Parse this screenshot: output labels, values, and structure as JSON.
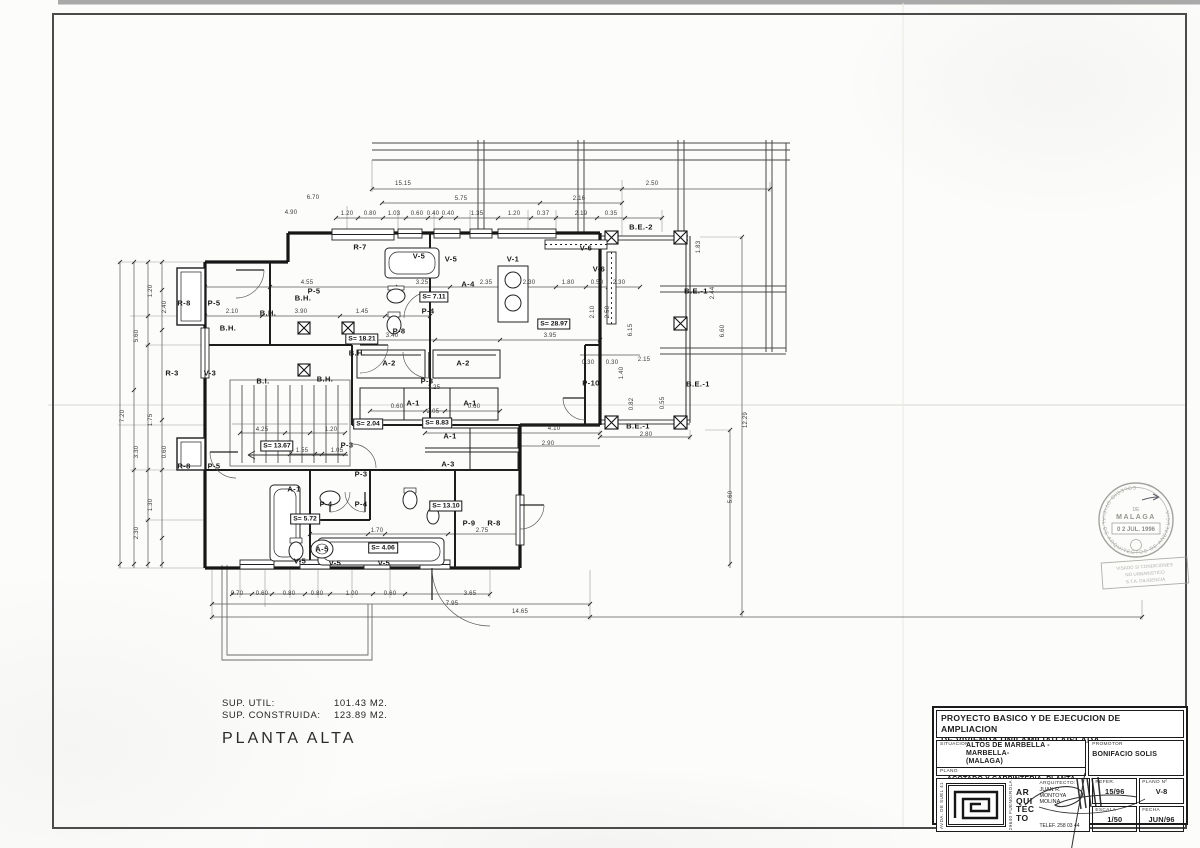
{
  "colors": {
    "ink": "#1a1a1a",
    "dim": "#3a3a3a",
    "frame": "#4b4b4b",
    "stamp": "#8a8a86"
  },
  "summary": {
    "sup_util_label": "SUP. UTIL:",
    "sup_util_value": "101.43 M2.",
    "sup_construida_label": "SUP. CONSTRUIDA:",
    "sup_construida_value": "123.89 M2.",
    "floor_title": "PLANTA ALTA"
  },
  "title_block": {
    "title_line1": "PROYECTO BASICO Y DE EJECUCION DE AMPLIACION",
    "title_line2": "DE VIVIENDA UNIFAMILIAR AISLADA",
    "situacion_label": "SITUACION",
    "situacion_value1": "ALTOS DE MARBELLA -MARBELLA-",
    "situacion_value2": "(MALAGA)",
    "plano_label": "PLANO",
    "plano_value": "ACOTADO Y CARPINTERIA, PLANTA ALTA",
    "promotor_label": "PROMOTOR",
    "promotor_value": "BONIFACIO SOLIS",
    "address_left": "AVDA. DE SUEL 41",
    "address_right": "29640 FUENGIROLA",
    "logo_word1": "AR",
    "logo_word2": "QUI",
    "logo_word3": "TEC",
    "logo_word4": "TO",
    "arquitecto_label": "ARQUITECTO:",
    "arquitecto_value": "JUAN R. MONTOYA MOLINA",
    "telefono": "TELEF. 258 03 44",
    "refer_label": "REFER.",
    "refer_value": "15/96",
    "plano_num_label": "PLANO Nº",
    "plano_num_value": "V-8",
    "escala_label": "ESCALA",
    "escala_value": "1/50",
    "fecha_label": "FECHA",
    "fecha_value": "JUN/96"
  },
  "stamp": {
    "arc_text": "COLEGIO OFICIAL DE ARQUITECTOS DE ANDALUCIA",
    "de": "DE",
    "place": "MALAGA",
    "date": "0 2 JUL. 1996",
    "visa_lines": [
      "VISADO S/ CONDICIONES",
      "NO URBANISTICO",
      "S.T.A.  DILIGENCIA"
    ]
  },
  "plan": {
    "annotations": [
      {
        "t": "R-7",
        "x": 360,
        "y": 247,
        "k": "c"
      },
      {
        "t": "P-5",
        "x": 314,
        "y": 291,
        "k": "c"
      },
      {
        "t": "V-5",
        "x": 419,
        "y": 256,
        "k": "c"
      },
      {
        "t": "V-5",
        "x": 451,
        "y": 259,
        "k": "c"
      },
      {
        "t": "V-1",
        "x": 513,
        "y": 259,
        "k": "c"
      },
      {
        "t": "A-4",
        "x": 468,
        "y": 284,
        "k": "c"
      },
      {
        "t": "P-4",
        "x": 428,
        "y": 311,
        "k": "c"
      },
      {
        "t": "P-8",
        "x": 399,
        "y": 331,
        "k": "c"
      },
      {
        "t": "B.H.",
        "x": 303,
        "y": 298,
        "k": "c"
      },
      {
        "t": "B.H.",
        "x": 268,
        "y": 313,
        "k": "c"
      },
      {
        "t": "B.H.",
        "x": 228,
        "y": 328,
        "k": "c"
      },
      {
        "t": "B.H.",
        "x": 357,
        "y": 353,
        "k": "c"
      },
      {
        "t": "B.H.",
        "x": 325,
        "y": 379,
        "k": "c"
      },
      {
        "t": "B.I.",
        "x": 263,
        "y": 381,
        "k": "c"
      },
      {
        "t": "R-8",
        "x": 184,
        "y": 303,
        "k": "c"
      },
      {
        "t": "P-5",
        "x": 214,
        "y": 303,
        "k": "c"
      },
      {
        "t": "R-3",
        "x": 172,
        "y": 373,
        "k": "c"
      },
      {
        "t": "V-3",
        "x": 210,
        "y": 373,
        "k": "c"
      },
      {
        "t": "V-6",
        "x": 586,
        "y": 248,
        "k": "c"
      },
      {
        "t": "V-6",
        "x": 599,
        "y": 269,
        "k": "c"
      },
      {
        "t": "B.E.-2",
        "x": 641,
        "y": 227,
        "k": "c"
      },
      {
        "t": "B.E.-1",
        "x": 696,
        "y": 291,
        "k": "c"
      },
      {
        "t": "B.E.-1",
        "x": 698,
        "y": 384,
        "k": "c"
      },
      {
        "t": "B.E.-1",
        "x": 638,
        "y": 426,
        "k": "c"
      },
      {
        "t": "P-10",
        "x": 591,
        "y": 383,
        "k": "c"
      },
      {
        "t": "A-2",
        "x": 389,
        "y": 363,
        "k": "c"
      },
      {
        "t": "A-2",
        "x": 463,
        "y": 363,
        "k": "c"
      },
      {
        "t": "P-3",
        "x": 427,
        "y": 381,
        "k": "c"
      },
      {
        "t": "A-1",
        "x": 413,
        "y": 403,
        "k": "c"
      },
      {
        "t": "A-1",
        "x": 470,
        "y": 403,
        "k": "c"
      },
      {
        "t": "A-1",
        "x": 450,
        "y": 436,
        "k": "c"
      },
      {
        "t": "A-3",
        "x": 448,
        "y": 464,
        "k": "c"
      },
      {
        "t": "P-3",
        "x": 347,
        "y": 445,
        "k": "c"
      },
      {
        "t": "P-3",
        "x": 361,
        "y": 474,
        "k": "c"
      },
      {
        "t": "A-1",
        "x": 294,
        "y": 489,
        "k": "c"
      },
      {
        "t": "P-4",
        "x": 326,
        "y": 504,
        "k": "c"
      },
      {
        "t": "P-4",
        "x": 361,
        "y": 504,
        "k": "c"
      },
      {
        "t": "P-5",
        "x": 214,
        "y": 466,
        "k": "c"
      },
      {
        "t": "R-8",
        "x": 184,
        "y": 466,
        "k": "c"
      },
      {
        "t": "A-5",
        "x": 322,
        "y": 549,
        "k": "c"
      },
      {
        "t": "V-5",
        "x": 300,
        "y": 561,
        "k": "c"
      },
      {
        "t": "V-5",
        "x": 335,
        "y": 563,
        "k": "c"
      },
      {
        "t": "V-5",
        "x": 384,
        "y": 563,
        "k": "c"
      },
      {
        "t": "P-9",
        "x": 469,
        "y": 523,
        "k": "c"
      },
      {
        "t": "R-8",
        "x": 494,
        "y": 523,
        "k": "c"
      },
      {
        "t": "S= 7.11",
        "x": 434,
        "y": 297,
        "k": "a"
      },
      {
        "t": "S= 18.21",
        "x": 362,
        "y": 339,
        "k": "a"
      },
      {
        "t": "S= 28.97",
        "x": 554,
        "y": 324,
        "k": "a"
      },
      {
        "t": "S= 2.04",
        "x": 368,
        "y": 424,
        "k": "a"
      },
      {
        "t": "S= 8.83",
        "x": 437,
        "y": 423,
        "k": "a"
      },
      {
        "t": "S= 13.67",
        "x": 277,
        "y": 446,
        "k": "a"
      },
      {
        "t": "S= 5.72",
        "x": 305,
        "y": 519,
        "k": "a"
      },
      {
        "t": "S= 4.06",
        "x": 383,
        "y": 548,
        "k": "a"
      },
      {
        "t": "S= 13.10",
        "x": 446,
        "y": 506,
        "k": "a"
      },
      {
        "t": "15.15",
        "x": 403,
        "y": 184,
        "k": "d"
      },
      {
        "t": "2.50",
        "x": 652,
        "y": 184,
        "k": "d"
      },
      {
        "t": "5.75",
        "x": 461,
        "y": 199,
        "k": "d"
      },
      {
        "t": "2.16",
        "x": 579,
        "y": 199,
        "k": "d"
      },
      {
        "t": "6.70",
        "x": 313,
        "y": 198,
        "k": "d"
      },
      {
        "t": "4.90",
        "x": 291,
        "y": 213,
        "k": "d"
      },
      {
        "t": "1.20",
        "x": 347,
        "y": 214,
        "k": "d"
      },
      {
        "t": "0.80",
        "x": 370,
        "y": 214,
        "k": "d"
      },
      {
        "t": "1.03",
        "x": 394,
        "y": 214,
        "k": "d"
      },
      {
        "t": "0.60",
        "x": 417,
        "y": 214,
        "k": "d"
      },
      {
        "t": "0.40",
        "x": 433,
        "y": 214,
        "k": "d"
      },
      {
        "t": "0.40",
        "x": 448,
        "y": 214,
        "k": "d"
      },
      {
        "t": "1.35",
        "x": 477,
        "y": 214,
        "k": "d"
      },
      {
        "t": "1.20",
        "x": 514,
        "y": 214,
        "k": "d"
      },
      {
        "t": "0.37",
        "x": 543,
        "y": 214,
        "k": "d"
      },
      {
        "t": "2.19",
        "x": 581,
        "y": 214,
        "k": "d"
      },
      {
        "t": "0.35",
        "x": 611,
        "y": 214,
        "k": "d"
      },
      {
        "t": "1.83",
        "x": 699,
        "y": 247,
        "k": "v"
      },
      {
        "t": "4.55",
        "x": 307,
        "y": 283,
        "k": "d"
      },
      {
        "t": "3.25",
        "x": 422,
        "y": 283,
        "k": "d"
      },
      {
        "t": "2.35",
        "x": 486,
        "y": 283,
        "k": "d"
      },
      {
        "t": "2.30",
        "x": 529,
        "y": 283,
        "k": "d"
      },
      {
        "t": "1.80",
        "x": 568,
        "y": 283,
        "k": "d"
      },
      {
        "t": "0.50",
        "x": 597,
        "y": 283,
        "k": "d"
      },
      {
        "t": "2.30",
        "x": 619,
        "y": 283,
        "k": "d"
      },
      {
        "t": "2.10",
        "x": 232,
        "y": 312,
        "k": "d"
      },
      {
        "t": "3.90",
        "x": 301,
        "y": 312,
        "k": "d"
      },
      {
        "t": "1.45",
        "x": 362,
        "y": 312,
        "k": "d"
      },
      {
        "t": "3.40",
        "x": 392,
        "y": 336,
        "k": "d"
      },
      {
        "t": "3.95",
        "x": 550,
        "y": 336,
        "k": "d"
      },
      {
        "t": "3.25",
        "x": 434,
        "y": 388,
        "k": "d"
      },
      {
        "t": "0.60",
        "x": 397,
        "y": 407,
        "k": "d"
      },
      {
        "t": "0.60",
        "x": 474,
        "y": 407,
        "k": "d"
      },
      {
        "t": "2.05",
        "x": 433,
        "y": 412,
        "k": "d"
      },
      {
        "t": "4.10",
        "x": 554,
        "y": 429,
        "k": "d"
      },
      {
        "t": "2.90",
        "x": 548,
        "y": 444,
        "k": "d"
      },
      {
        "t": "4.25",
        "x": 262,
        "y": 430,
        "k": "d"
      },
      {
        "t": "1.20",
        "x": 331,
        "y": 430,
        "k": "d"
      },
      {
        "t": "1.55",
        "x": 302,
        "y": 451,
        "k": "d"
      },
      {
        "t": "1.05",
        "x": 337,
        "y": 451,
        "k": "d"
      },
      {
        "t": "1.70",
        "x": 377,
        "y": 531,
        "k": "d"
      },
      {
        "t": "2.75",
        "x": 482,
        "y": 531,
        "k": "d"
      },
      {
        "t": "2.80",
        "x": 646,
        "y": 435,
        "k": "d"
      },
      {
        "t": "2.15",
        "x": 644,
        "y": 360,
        "k": "d"
      },
      {
        "t": "0.30",
        "x": 588,
        "y": 363,
        "k": "d"
      },
      {
        "t": "0.30",
        "x": 612,
        "y": 363,
        "k": "d"
      },
      {
        "t": "0.70",
        "x": 237,
        "y": 594,
        "k": "d"
      },
      {
        "t": "0.60",
        "x": 262,
        "y": 594,
        "k": "d"
      },
      {
        "t": "0.80",
        "x": 289,
        "y": 594,
        "k": "d"
      },
      {
        "t": "0.80",
        "x": 317,
        "y": 594,
        "k": "d"
      },
      {
        "t": "1.00",
        "x": 352,
        "y": 594,
        "k": "d"
      },
      {
        "t": "0.60",
        "x": 390,
        "y": 594,
        "k": "d"
      },
      {
        "t": "3.65",
        "x": 470,
        "y": 594,
        "k": "d"
      },
      {
        "t": "7.95",
        "x": 452,
        "y": 604,
        "k": "d"
      },
      {
        "t": "14.65",
        "x": 520,
        "y": 612,
        "k": "d"
      },
      {
        "t": "1.20",
        "x": 151,
        "y": 291,
        "k": "v"
      },
      {
        "t": "2.40",
        "x": 165,
        "y": 307,
        "k": "v"
      },
      {
        "t": "5.60",
        "x": 137,
        "y": 336,
        "k": "v"
      },
      {
        "t": "1.75",
        "x": 151,
        "y": 420,
        "k": "v"
      },
      {
        "t": "7.20",
        "x": 123,
        "y": 416,
        "k": "v"
      },
      {
        "t": "3.30",
        "x": 137,
        "y": 452,
        "k": "v"
      },
      {
        "t": "0.60",
        "x": 165,
        "y": 452,
        "k": "v"
      },
      {
        "t": "1.30",
        "x": 151,
        "y": 505,
        "k": "v"
      },
      {
        "t": "2.30",
        "x": 137,
        "y": 533,
        "k": "v"
      },
      {
        "t": "2.10",
        "x": 593,
        "y": 312,
        "k": "v"
      },
      {
        "t": "2.50",
        "x": 608,
        "y": 312,
        "k": "v"
      },
      {
        "t": "6.15",
        "x": 631,
        "y": 330,
        "k": "v"
      },
      {
        "t": "6.60",
        "x": 723,
        "y": 331,
        "k": "v"
      },
      {
        "t": "2.44",
        "x": 713,
        "y": 293,
        "k": "v"
      },
      {
        "t": "1.40",
        "x": 622,
        "y": 373,
        "k": "v"
      },
      {
        "t": "0.82",
        "x": 632,
        "y": 404,
        "k": "v"
      },
      {
        "t": "0.55",
        "x": 663,
        "y": 403,
        "k": "v"
      },
      {
        "t": "12.29",
        "x": 746,
        "y": 420,
        "k": "v"
      },
      {
        "t": "5.60",
        "x": 731,
        "y": 497,
        "k": "v"
      }
    ]
  }
}
